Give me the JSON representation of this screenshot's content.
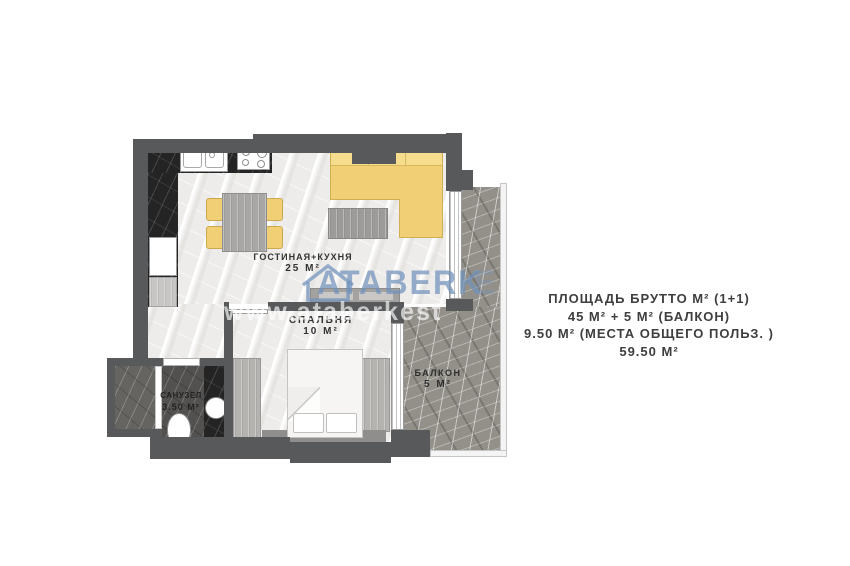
{
  "rooms": {
    "living": {
      "name": "ГОСТИНАЯ+КУХНЯ",
      "area": "25 М²"
    },
    "bedroom": {
      "name": "СПАЛЬНЯ",
      "area": "10 М²"
    },
    "bathroom": {
      "name": "САНУЗЕЛ",
      "area": "3.50 М²"
    },
    "balcony": {
      "name": "БАЛКОН",
      "area": "5 М²"
    }
  },
  "summary": {
    "line1": "ПЛОЩАДЬ БРУТТО М² (1+1)",
    "line2": "45 М² + 5 М² (БАЛКОН)",
    "line3": "9.50 М² (МЕСТА ОБЩЕГО ПОЛЬЗ. )",
    "line4": "59.50 М²"
  },
  "watermark": {
    "brand": "ATABERK",
    "brand_clip": "E",
    "url": "www.ataberkest"
  },
  "colors": {
    "wall": "#58595b",
    "sofa_yellow": "#f1cf74",
    "marble_dark": "#242424",
    "watermark_blue": "#7092bb"
  }
}
